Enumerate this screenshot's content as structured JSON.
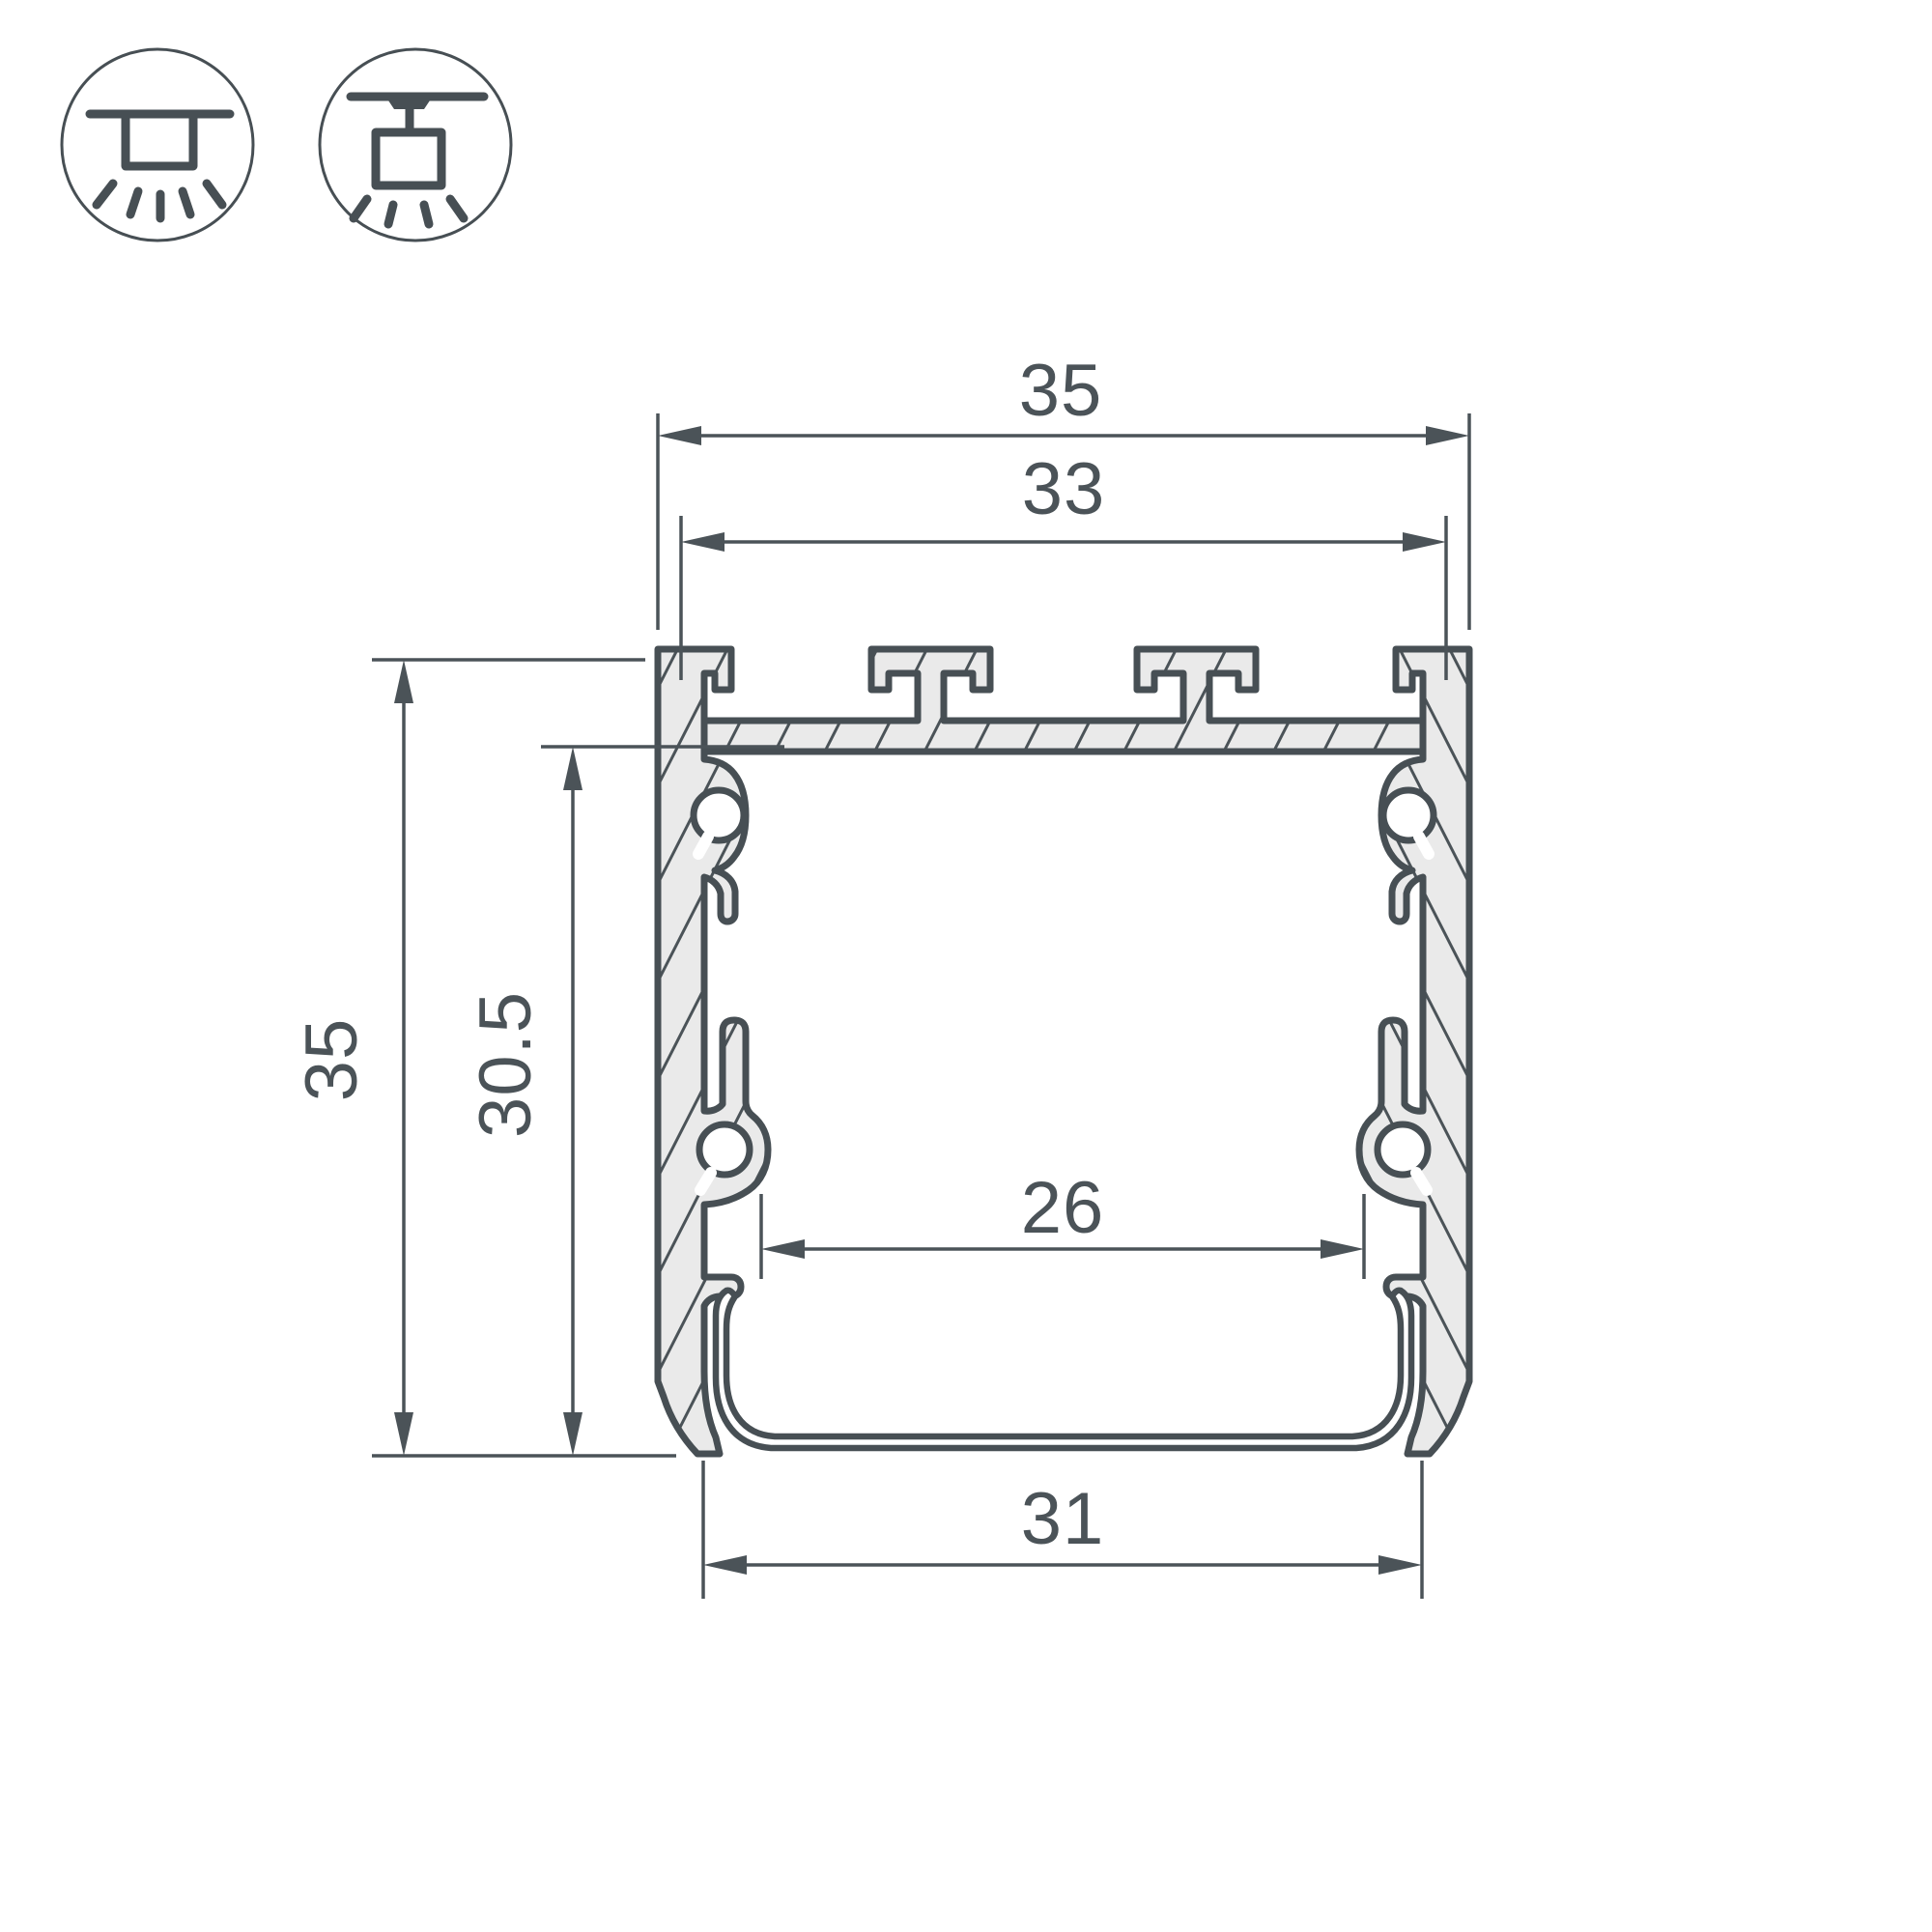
{
  "colors": {
    "line": "#474F54",
    "label": "#4B5358",
    "hatch_fill": "#EAEAEA",
    "background": "#FFFFFF"
  },
  "icons": [
    {
      "name": "ceiling-surface-mount-icon"
    },
    {
      "name": "pendant-suspension-mount-icon"
    }
  ],
  "drawing": {
    "dimensions": {
      "outer_width_top": "35",
      "inner_width_top": "33",
      "overall_height": "35",
      "inner_height": "30.5",
      "inner_channel_width": "26",
      "bottom_width": "31"
    }
  }
}
